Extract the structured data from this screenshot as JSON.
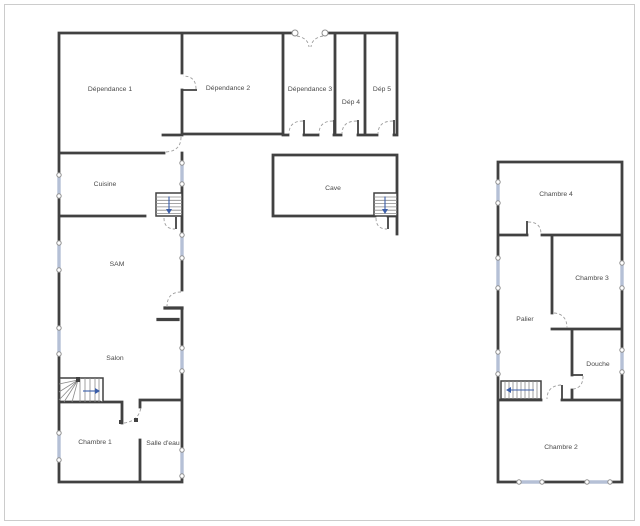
{
  "colors": {
    "background": "#ffffff",
    "wall": "#414141",
    "window_band": "#b5c0d6",
    "window_ring": "#8f8f8f",
    "door_arc": "#9e9e9e",
    "stair_tread": "#8a8a8a",
    "stair_arrow": "#3a5da8",
    "label": "#4a4a4a",
    "frame": "#cccccc"
  },
  "rooms": {
    "dependance1": {
      "label": "Dépendance 1"
    },
    "dependance2": {
      "label": "Dépendance 2"
    },
    "dependance3": {
      "label": "Dépendance 3"
    },
    "dep4": {
      "label": "Dép 4"
    },
    "dep5": {
      "label": "Dép 5"
    },
    "cuisine": {
      "label": "Cuisine"
    },
    "cave": {
      "label": "Cave"
    },
    "sam": {
      "label": "SAM"
    },
    "salon": {
      "label": "Salon"
    },
    "chambre1": {
      "label": "Chambre 1"
    },
    "salle_deau": {
      "label": "Salle d'eau"
    },
    "chambre4": {
      "label": "Chambre 4"
    },
    "chambre3": {
      "label": "Chambre 3"
    },
    "palier": {
      "label": "Palier"
    },
    "douche": {
      "label": "Douche"
    },
    "chambre2": {
      "label": "Chambre 2"
    }
  }
}
